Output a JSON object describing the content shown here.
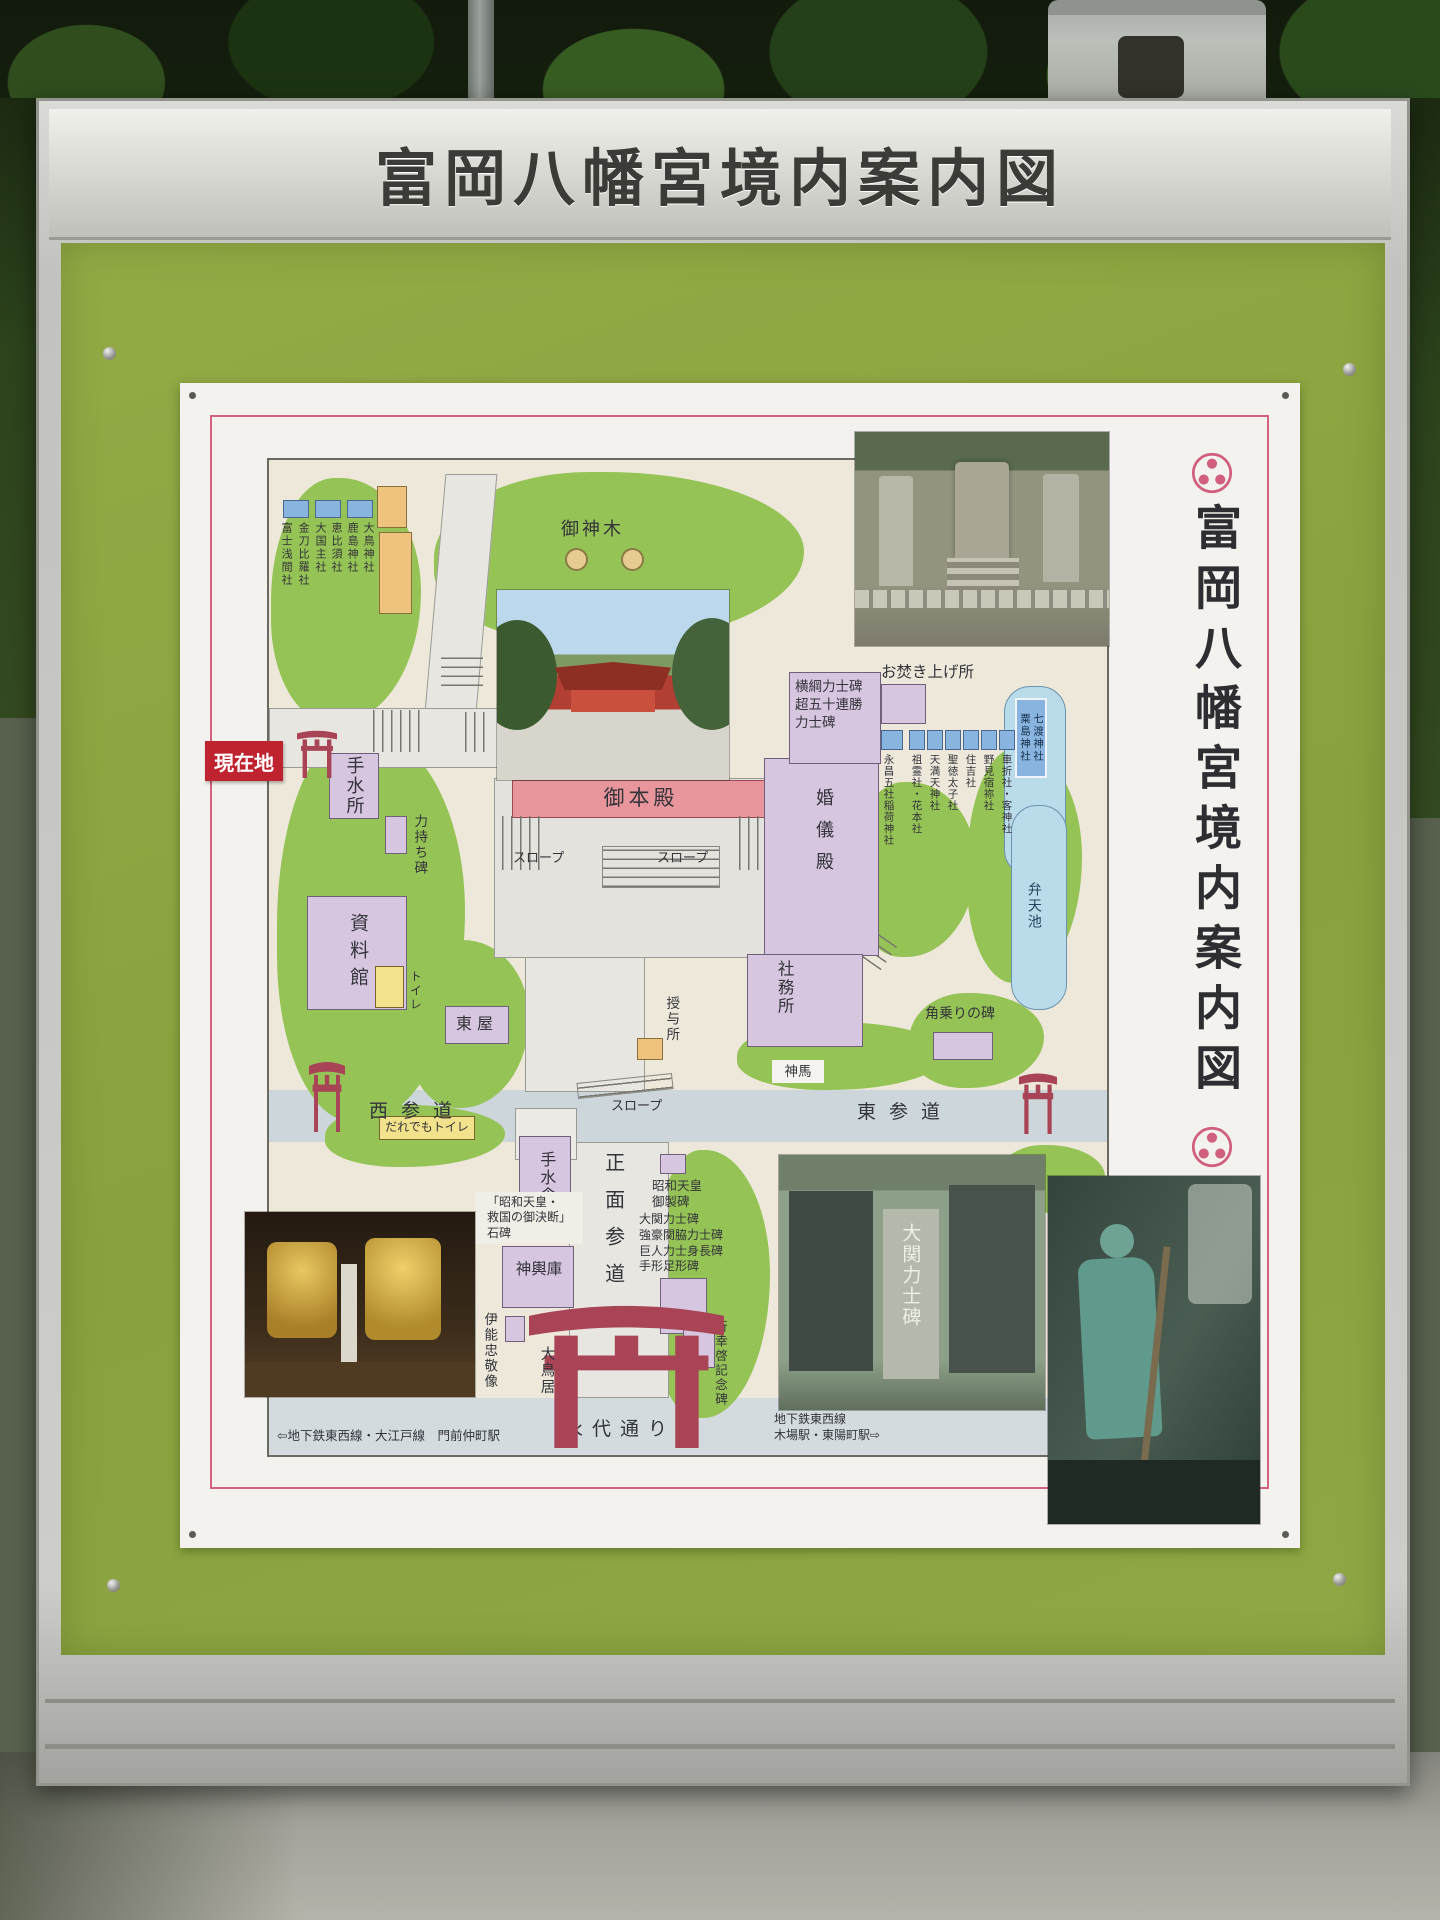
{
  "sign": {
    "title": "富岡八幡宮境内案内図",
    "vertical_title": "富岡八幡宮境内案内図"
  },
  "map": {
    "current_location": "現在地",
    "roads": {
      "west": "西参道",
      "east": "東参道",
      "front": "正面参道",
      "eitai": "永代通り"
    },
    "stations": {
      "left": "⇦地下鉄東西線・大江戸線　門前仲町駅",
      "right": "地下鉄東西線\n木場駅・東陽町駅⇨"
    },
    "facilities": {
      "temizusho": "手水所",
      "temizusha": "手水舎",
      "chikaramochi_hi": "力持ち碑",
      "goshinboku": "御神木",
      "gohonden": "御本殿",
      "slope": "スロープ",
      "shiryokan": "資料館",
      "toilet": "トイレ",
      "daredemo_toilet": "だれでもトイレ",
      "azumaya": "東屋",
      "kongiden": "婚儀殿",
      "shamusho": "社務所",
      "juyosho": "授与所",
      "shinme": "神馬",
      "mikoshiko": "神輿庫",
      "otakiage": "お焚き上げ所",
      "otorii": "大鳥居"
    },
    "monuments": {
      "yokozuna": "横綱力士碑\n超五十連勝\n力士碑",
      "showa_gyosei": "昭和天皇\n御製碑",
      "ozeki_group": "大関力士碑\n強豪関脇力士碑\n巨人力士身長碑\n手形足形碑",
      "kyukoku": "「昭和天皇・\n救国の御決断」\n石碑",
      "ino_tadataka": "伊能忠敬像",
      "gyokokei": "行幸啓記念碑",
      "kakunori": "角乗りの碑"
    },
    "water": {
      "benten_pond": "弁天池",
      "nanawatari": "七渡神社\n粟島神社"
    },
    "shrines_nw": [
      "大鳥神社",
      "鹿島神社",
      "恵比須社",
      "大国主社",
      "金刀比羅社",
      "富士浅間社"
    ],
    "shrines_e": [
      "永昌五社稲荷神社",
      "祖霊社・花本社",
      "天満天神社",
      "聖徳太子社",
      "住吉社",
      "野見宿祢社",
      "車折社・客神社"
    ],
    "photo_text": {
      "ozeki_stone": "大関力士碑"
    }
  },
  "colors": {
    "panel_green": "#8fa742",
    "current_red": "#bf2330",
    "torii_red": "#a84456",
    "pink_border": "#d4627e",
    "grass_green": "#95c355",
    "building_purple": "#d7c6e0",
    "water_blue": "#badbe9"
  }
}
